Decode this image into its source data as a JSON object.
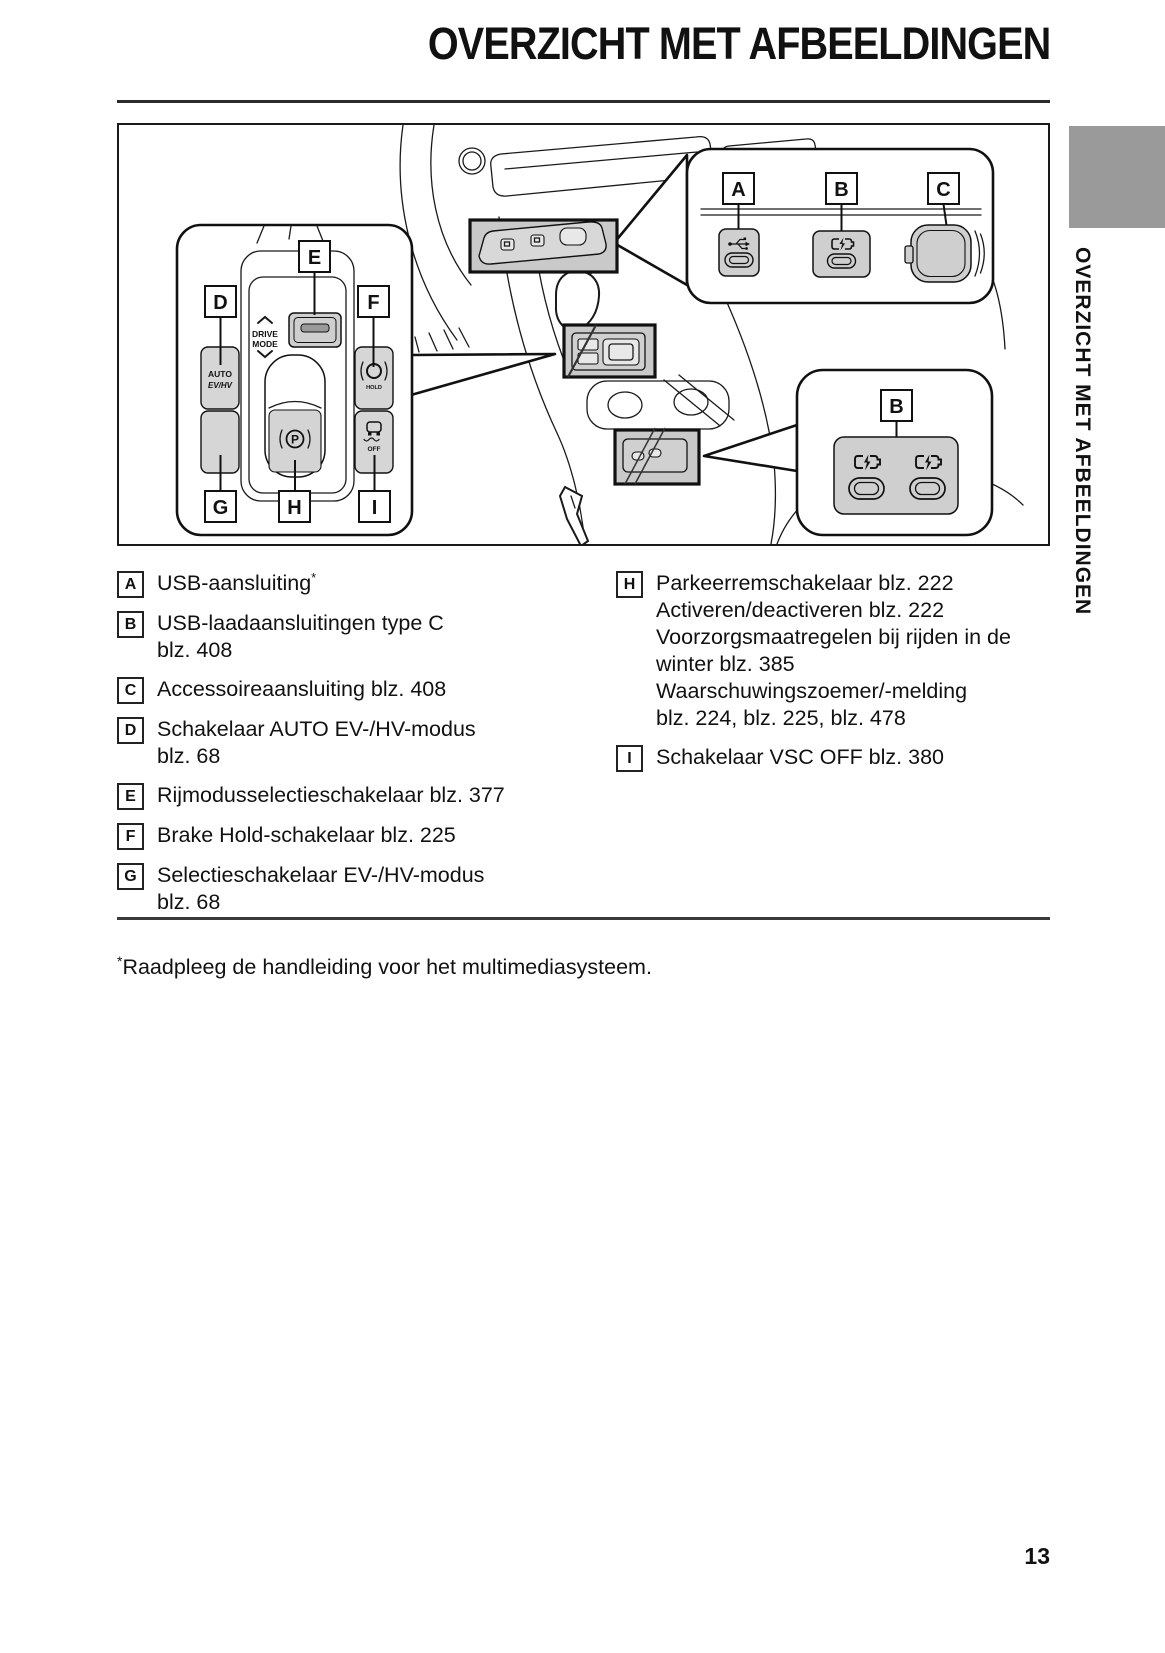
{
  "page": {
    "title": "OVERZICHT MET AFBEELDINGEN",
    "sidebar_vertical_text": "OVERZICHT MET AFBEELDINGEN",
    "page_number": "13",
    "footnote_marker": "*",
    "footnote_text": "Raadpleeg de handleiding voor het multimediasysteem."
  },
  "figure": {
    "labels": {
      "a": "A",
      "b": "B",
      "c": "C",
      "d": "D",
      "e": "E",
      "f": "F",
      "g": "G",
      "h": "H",
      "i": "I"
    },
    "switch_text": {
      "drive": "DRIVE",
      "mode": "MODE",
      "auto": "AUTO",
      "evhv": "EV/HV",
      "hv": "HV",
      "ev": "EV",
      "hold": "HOLD",
      "hold_chg": "HOLD CHG",
      "off": "OFF",
      "p": "P"
    },
    "icons": {
      "usb_port": "usb-trident-icon",
      "usb_charge_port": "battery-charging-icon",
      "accessory_socket": "power-outlet-socket-icon",
      "brake_hold": "brake-hold-ring-icon",
      "vsc_off": "car-skid-icon",
      "parking_brake": "circled-p-icon",
      "drive_mode": "chevron-up-down-icon",
      "ev_mode": "ev-cycle-icon"
    },
    "colors": {
      "inset_fill": "#c9c9c9",
      "button_fill": "#d6d6d6",
      "port_fill": "#cfcfcf",
      "sidebar_tab": "#9a9a9a",
      "line": "#1a1a1a"
    }
  },
  "legend": {
    "left": [
      {
        "key": "A",
        "text": "USB-aansluiting",
        "sup": "*"
      },
      {
        "key": "B",
        "text": "USB-laadaansluitingen type C",
        "ref": "blz. 408"
      },
      {
        "key": "C",
        "text": "Accessoireaansluiting blz. 408"
      },
      {
        "key": "D",
        "text": "Schakelaar AUTO EV-/HV-modus",
        "ref": "blz. 68"
      },
      {
        "key": "E",
        "text": "Rijmodusselectieschakelaar blz. 377"
      },
      {
        "key": "F",
        "text": "Brake Hold-schakelaar blz. 225"
      },
      {
        "key": "G",
        "text": "Selectieschakelaar EV-/HV-modus",
        "ref": "blz. 68"
      }
    ],
    "right": [
      {
        "key": "H",
        "lines": [
          "Parkeerremschakelaar blz. 222",
          "Activeren/deactiveren blz. 222",
          "Voorzorgsmaatregelen bij rijden in de",
          "winter blz. 385",
          "Waarschuwingszoemer/-melding",
          "blz. 224, blz. 225, blz. 478"
        ]
      },
      {
        "key": "I",
        "lines": [
          "Schakelaar VSC OFF blz. 380"
        ]
      }
    ]
  }
}
